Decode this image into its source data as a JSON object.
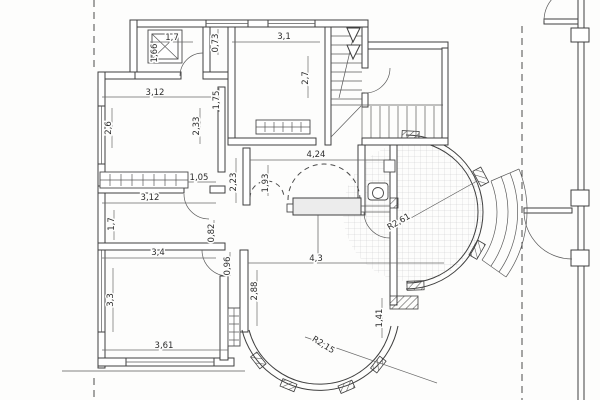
{
  "document": {
    "kind": "scanned architectural floor plan",
    "visible_text_language": "metric dimensions with decimal commas"
  },
  "colors": {
    "paper": "#fdfdfc",
    "line": "#3f3f3f",
    "dimension_text": "#2d2d2d",
    "tile_grid": "#c9c9c9",
    "hatch": "#555555"
  },
  "elements": [
    "shower-tray",
    "staircase-up",
    "stair-direction-arrow",
    "entry-door-arc",
    "radiator-horizontal",
    "radiator-vertical",
    "radiator-under-window",
    "arched-opening-small",
    "arched-opening-large",
    "counter",
    "wc-toilet",
    "wc-sink",
    "round-terrace-tiled",
    "terrace-radius-line",
    "exterior-curved-steps",
    "bay-window-curved",
    "property-line-left",
    "property-line-right",
    "neighbor-wall",
    "neighbor-doors",
    "windows"
  ],
  "dimensions": [
    {
      "label": "1,7",
      "x": 172,
      "y": 40,
      "rotate": 0
    },
    {
      "label": "1,66",
      "x": 157,
      "y": 53,
      "rotate": -90
    },
    {
      "label": "0,73",
      "x": 218,
      "y": 43,
      "rotate": -90
    },
    {
      "label": "3,1",
      "x": 284,
      "y": 39,
      "rotate": 0
    },
    {
      "label": "2,7",
      "x": 308,
      "y": 78,
      "rotate": -90
    },
    {
      "label": "3,12",
      "x": 155,
      "y": 95,
      "rotate": 0
    },
    {
      "label": "1,75",
      "x": 219,
      "y": 100,
      "rotate": -90
    },
    {
      "label": "2,6",
      "x": 111,
      "y": 128,
      "rotate": -90
    },
    {
      "label": "2,33",
      "x": 199,
      "y": 126,
      "rotate": -90
    },
    {
      "label": "1,05",
      "x": 199,
      "y": 180,
      "rotate": 0
    },
    {
      "label": "3,12",
      "x": 150,
      "y": 200,
      "rotate": 0
    },
    {
      "label": "1,7",
      "x": 114,
      "y": 224,
      "rotate": -90
    },
    {
      "label": "0,82",
      "x": 214,
      "y": 233,
      "rotate": -90
    },
    {
      "label": "2,23",
      "x": 236,
      "y": 182,
      "rotate": -90
    },
    {
      "label": "1,93",
      "x": 268,
      "y": 183,
      "rotate": -90
    },
    {
      "label": "4,24",
      "x": 316,
      "y": 157,
      "rotate": 0
    },
    {
      "label": "3,4",
      "x": 158,
      "y": 255,
      "rotate": 0
    },
    {
      "label": "0,96",
      "x": 230,
      "y": 266,
      "rotate": -90
    },
    {
      "label": "3,3",
      "x": 113,
      "y": 300,
      "rotate": -90
    },
    {
      "label": "3,61",
      "x": 164,
      "y": 348,
      "rotate": 0
    },
    {
      "label": "2,88",
      "x": 257,
      "y": 291,
      "rotate": -90
    },
    {
      "label": "4,3",
      "x": 316,
      "y": 261,
      "rotate": 0
    },
    {
      "label": "1,41",
      "x": 382,
      "y": 318,
      "rotate": -90
    },
    {
      "label": "R2,15",
      "x": 322,
      "y": 347,
      "rotate": 32
    },
    {
      "label": "R2,61",
      "x": 400,
      "y": 224,
      "rotate": -30
    }
  ]
}
